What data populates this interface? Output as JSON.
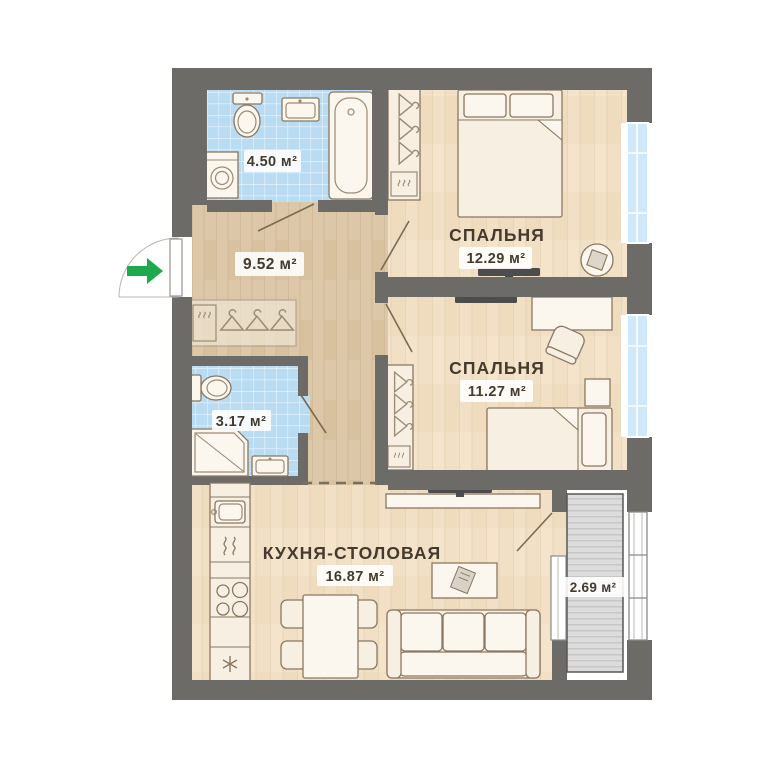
{
  "plan": {
    "kind": "apartment-floor-plan",
    "rooms": {
      "bathroom_main": {
        "area_label": "4.50 м²"
      },
      "hallway": {
        "area_label": "9.52 м²"
      },
      "bedroom_1": {
        "name": "СПАЛЬНЯ",
        "area_label": "12.29 м²"
      },
      "bedroom_2": {
        "name": "СПАЛЬНЯ",
        "area_label": "11.27 м²"
      },
      "bathroom_small": {
        "area_label": "3.17 м²"
      },
      "kitchen_dining": {
        "name": "КУХНЯ-СТОЛОВАЯ",
        "area_label": "16.87 м²"
      },
      "balcony": {
        "area_label": "2.69 м²"
      }
    },
    "colors": {
      "wall": "#6c6b67",
      "wood_floor": "#f1e0c6",
      "hallway_floor": "#dcc7a8",
      "bathroom_tile": "#b9dcf3",
      "window_glass": "#cfe8fa",
      "balcony_deck": "#dcdcdc",
      "furniture": "#f6efe2",
      "outline": "#8a7862",
      "label_text": "#443a2e",
      "entrance_arrow": "#1ea94c",
      "tv": "#4c4c4c"
    },
    "icons": [
      "entrance-arrow-icon",
      "toilet-icon",
      "bath-sink-icon",
      "bathtub-icon",
      "washing-machine-icon",
      "shower-icon",
      "hanger-icon",
      "coat-rack",
      "wardrobe",
      "double-bed-icon",
      "single-bed-icon",
      "pouf-icon",
      "tv-icon",
      "desk",
      "desk-chair-icon",
      "dining-table",
      "dining-chair-icon",
      "sofa",
      "coffee-table-icon",
      "kitchen-sink-icon",
      "stove-icon",
      "fridge-snowflake-icon",
      "window"
    ]
  }
}
